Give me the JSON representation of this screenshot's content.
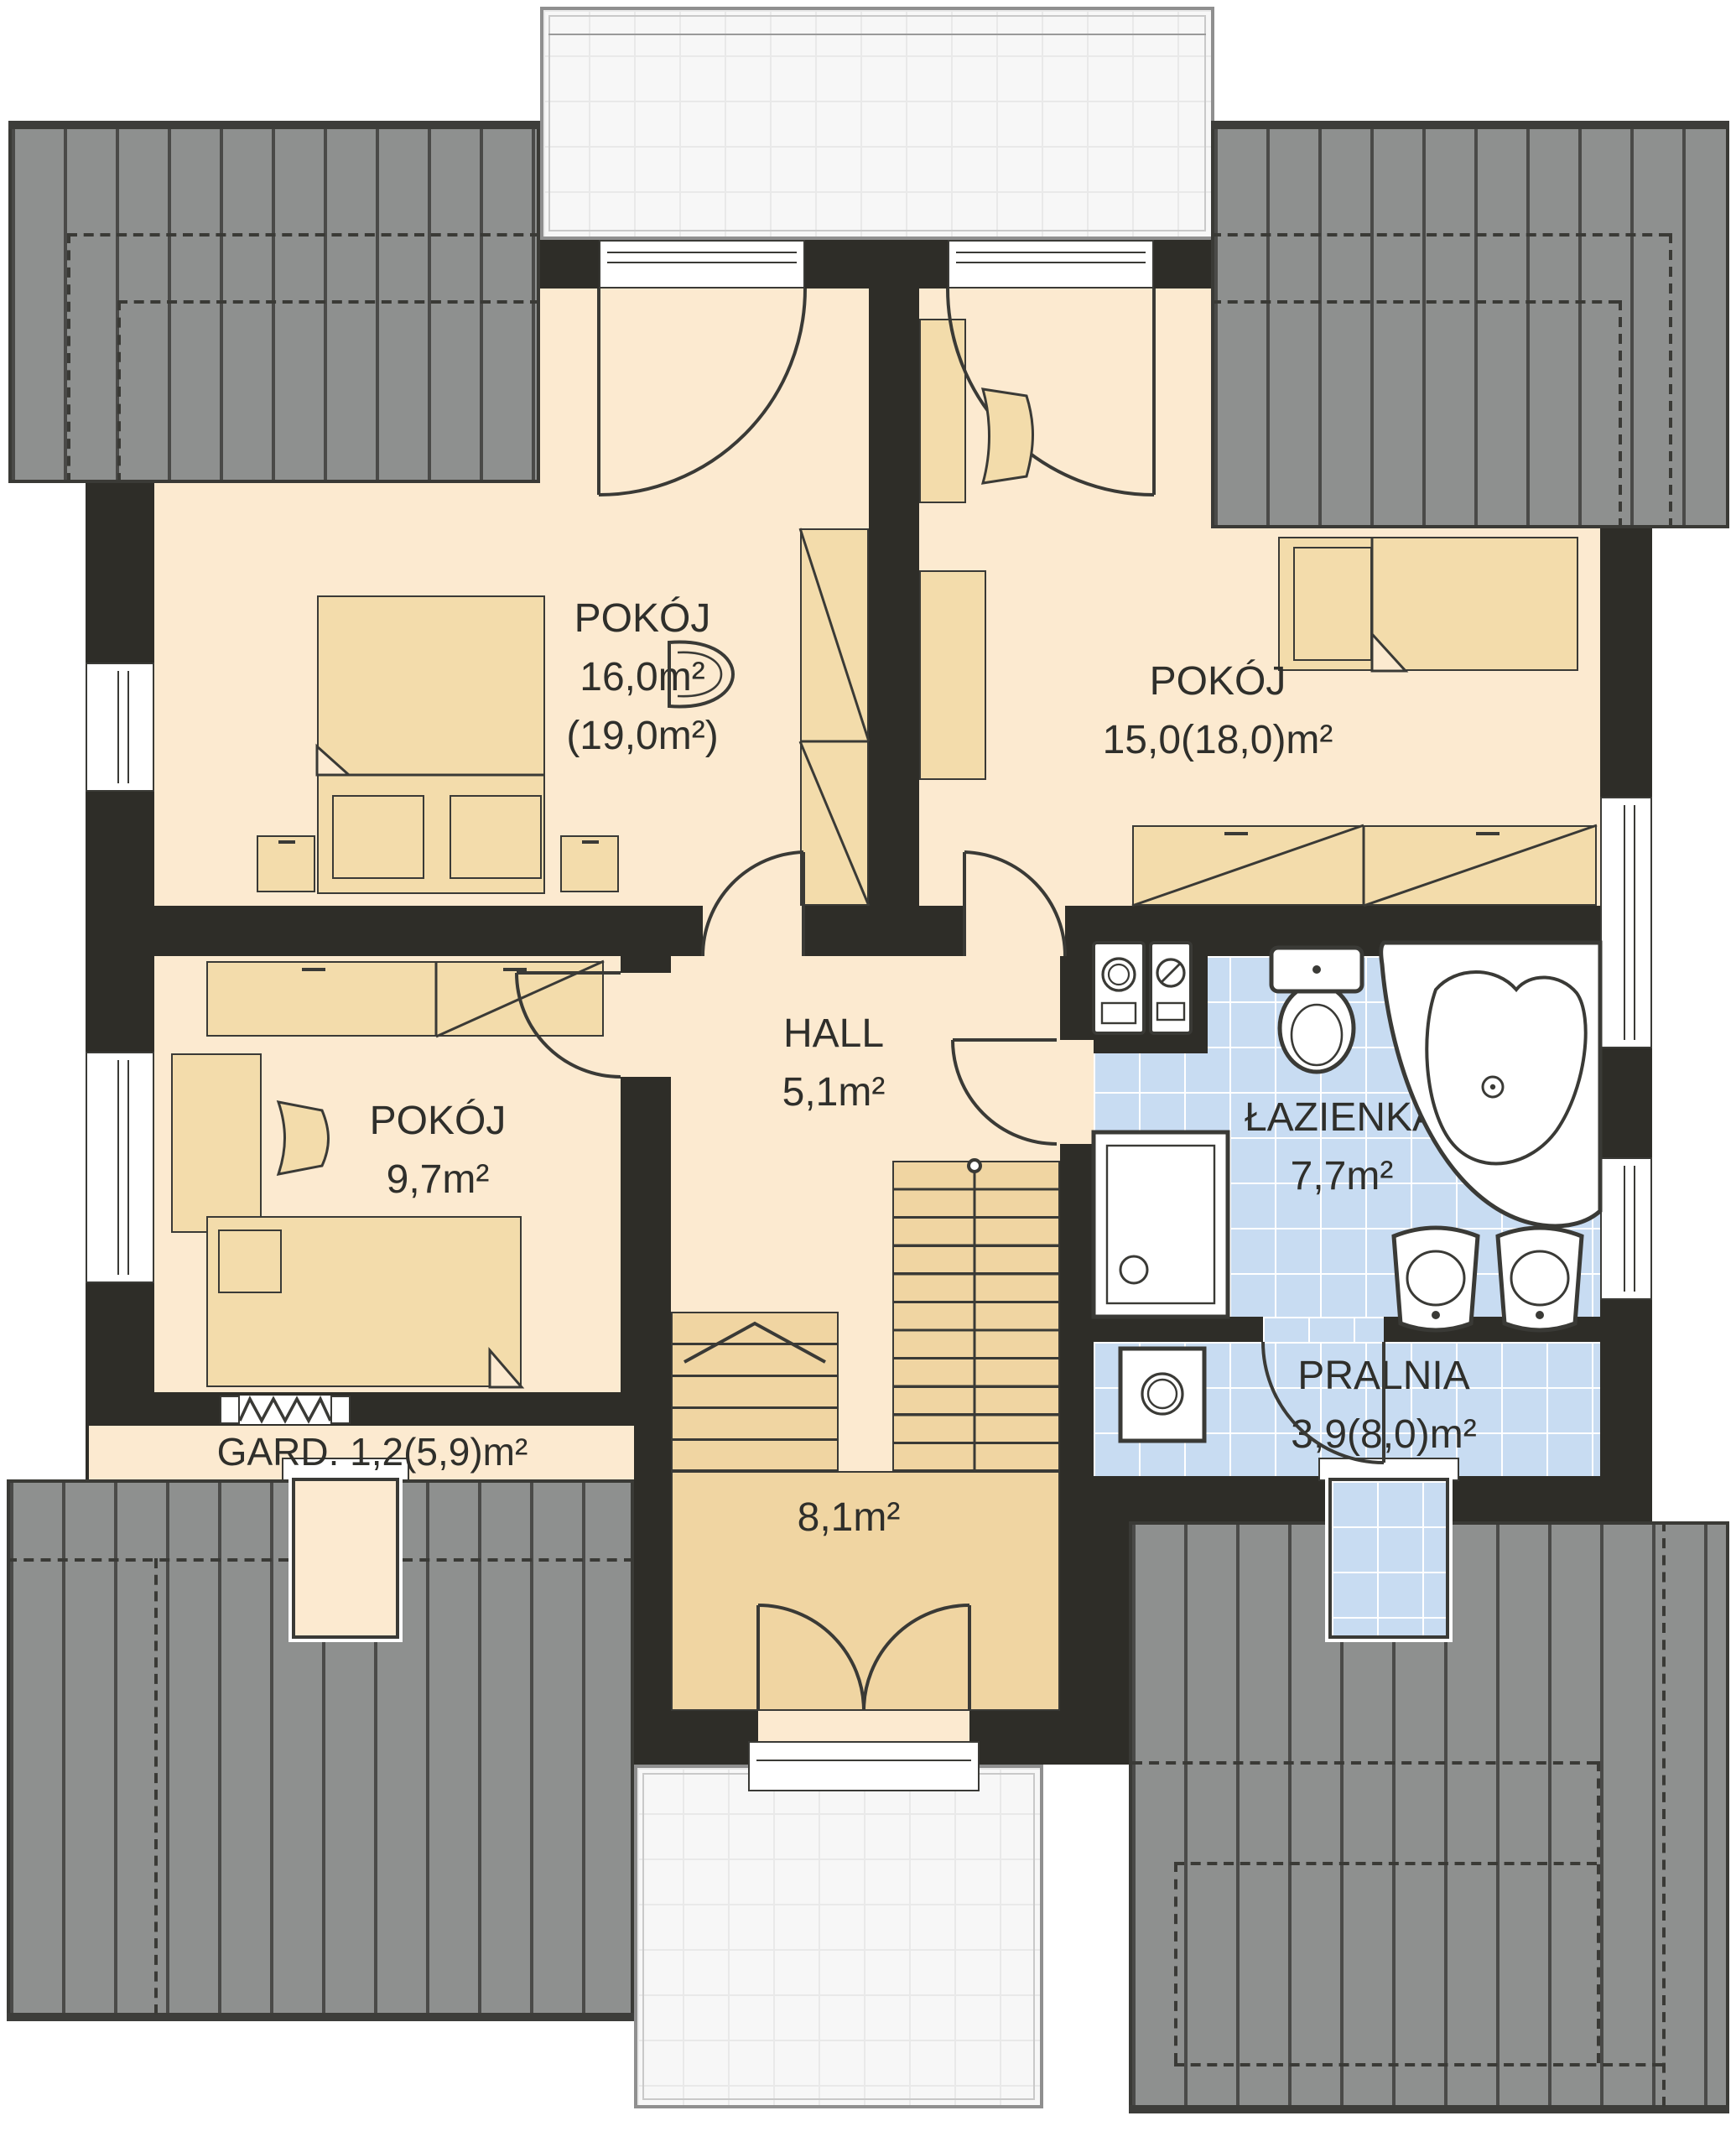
{
  "rooms": {
    "pokoj_1": {
      "name": "POKÓJ",
      "area_line1": "16,0m²",
      "area_line2": "(19,0m²)"
    },
    "pokoj_2": {
      "name": "POKÓJ",
      "area_line1": "15,0(18,0)m²"
    },
    "pokoj_3": {
      "name": "POKÓJ",
      "area_line1": "9,7m²"
    },
    "hall": {
      "name": "HALL",
      "area_line1": "5,1m²"
    },
    "lazienka": {
      "name": "ŁAZIENKA",
      "area_line1": "7,7m²"
    },
    "pralnia": {
      "name": "PRALNIA",
      "area_line1": "3,9(8,0)m²"
    },
    "garderoba": {
      "name": "GARD.",
      "area_line1": "1,2(5,9)m²"
    },
    "staircase": {
      "area_line1": "8,1m²"
    }
  },
  "colors": {
    "wall": "#2e2d28",
    "floor": "#fcead0",
    "furniture": "#f3dcab",
    "stairs": "#f0d5a2",
    "tile": "#c8dcf2",
    "tile_line": "#ffffff",
    "roof": "#8e908f",
    "roof_line": "#4a4a48",
    "terrace": "#f7f7f7",
    "terrace_line": "#e9e9e9",
    "outline": "#3a3a36",
    "band": "#3d3d3a",
    "label": "#2f2f2b",
    "white": "#ffffff"
  }
}
